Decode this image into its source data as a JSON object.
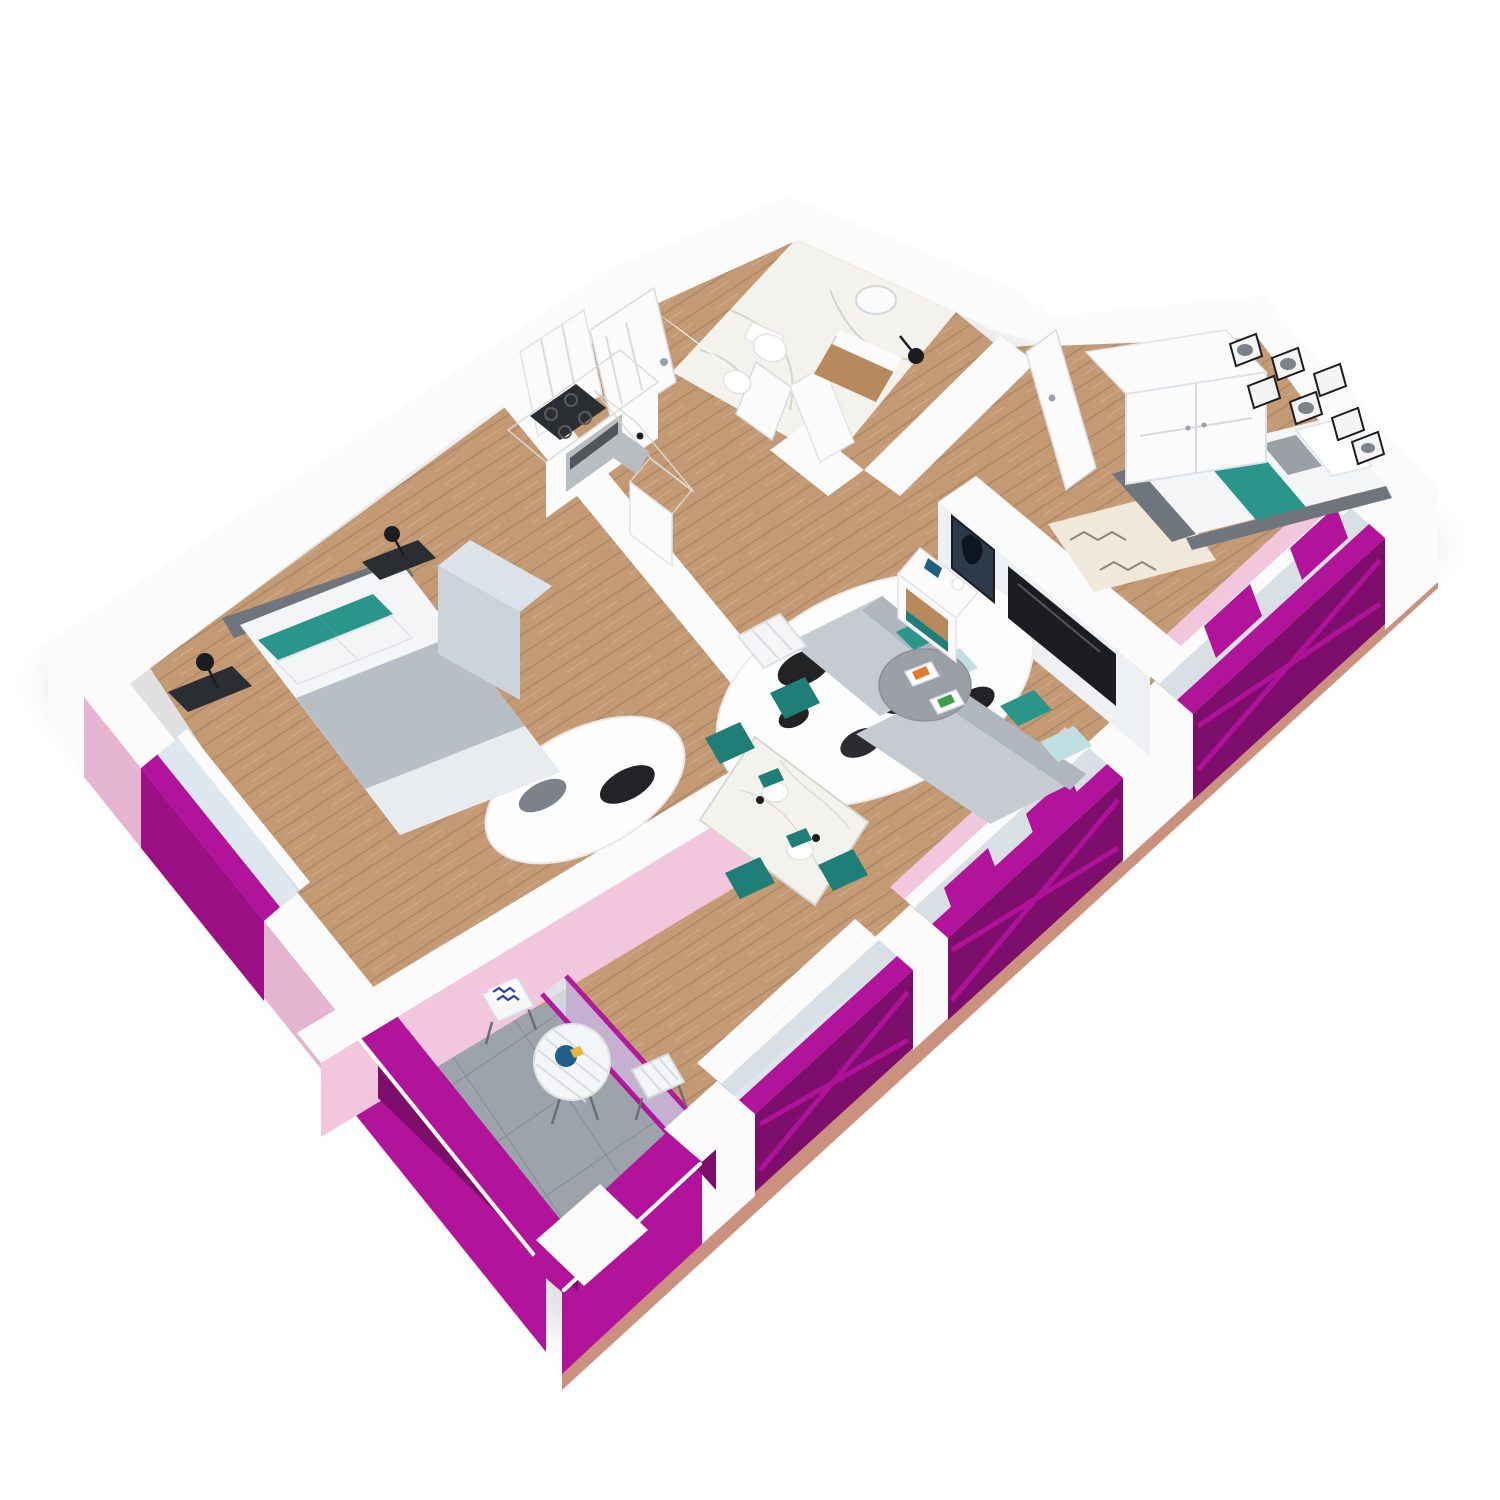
{
  "scene": {
    "kind": "3d-floorplan-cutaway-render",
    "view": "axonometric from south-east",
    "rooms": [
      {
        "id": "master-bedroom",
        "items": [
          "double-bed",
          "teal-pillows",
          "white-pillows",
          "nightstand-left",
          "nightstand-right",
          "black-table-lamps",
          "wardrobe",
          "cowhide-rug",
          "window"
        ]
      },
      {
        "id": "kitchen",
        "items": [
          "l-shaped-counter",
          "cooktop",
          "oven",
          "sink",
          "bar-block"
        ]
      },
      {
        "id": "hallway",
        "items": [
          "entry-door",
          "closet-doors"
        ]
      },
      {
        "id": "bathroom",
        "items": [
          "toilet",
          "bidet",
          "wood-vanity",
          "round-mirror",
          "black-wall-lamp",
          "shower-half-wall",
          "marble-floor"
        ]
      },
      {
        "id": "bedroom-2",
        "items": [
          "single-bed",
          "teal-runner",
          "white-wardrobe",
          "gallery-wall-7-frames",
          "berber-rug",
          "open-door",
          "window-with-juliet-railing"
        ]
      },
      {
        "id": "living-dining",
        "items": [
          "corner-sofa",
          "teal-and-aqua-cushions",
          "round-coffee-table",
          "magazines",
          "cowhide-rug",
          "quilted-armchair",
          "media-wall",
          "tv",
          "horse-artwork",
          "sideboard",
          "marble-dining-table",
          "four-teal-chairs",
          "place-settings",
          "floor-to-ceiling-windows"
        ]
      },
      {
        "id": "balcony",
        "items": [
          "white-bistro-table",
          "two-folding-chairs",
          "zigzag-cushion",
          "blue-plate",
          "magenta-railings",
          "grey-tile-floor"
        ]
      }
    ]
  },
  "palette": {
    "white": "#ffffff",
    "wall": "#fbfbfc",
    "wallShade": "#eef1f4",
    "wallDark": "#dde2e8",
    "wood": "#c49a74",
    "marble": "#f4f2ec",
    "tile": "#9ca3ab",
    "salmon": "#c9917e",
    "magenta": "#b2139b",
    "magentaDark": "#7d0e6b",
    "magentaDeep": "#9c1085",
    "pinkFace": "#e5b4d0",
    "pinkInner": "#f2c6dc",
    "glass": "#dce8f2",
    "teal": "#2a958b",
    "tealDark": "#1f7e78",
    "aqua": "#bfdfe2",
    "sofa": "#c6cbd1",
    "sofaDark": "#afb6be",
    "duvet": "#b8bec6",
    "linen": "#f4f5f7",
    "blanket": "#e9ecef",
    "headboard": "#6e757d",
    "grayTable": "#9aa0a6",
    "black": "#1b1d20",
    "metal": "#2a2d31",
    "steel": "#b8bdc2",
    "woodFurn": "#b8895c",
    "cabinet": "#cbd3db",
    "cabinetTop": "#dce2e9",
    "navy": "#2c3a49",
    "cream": "#efe8db",
    "plateBlue": "#205e87",
    "yellow": "#e9b43c",
    "orange": "#e07b2f",
    "green": "#3f9e4d",
    "shadow": "#1c1c1c"
  }
}
